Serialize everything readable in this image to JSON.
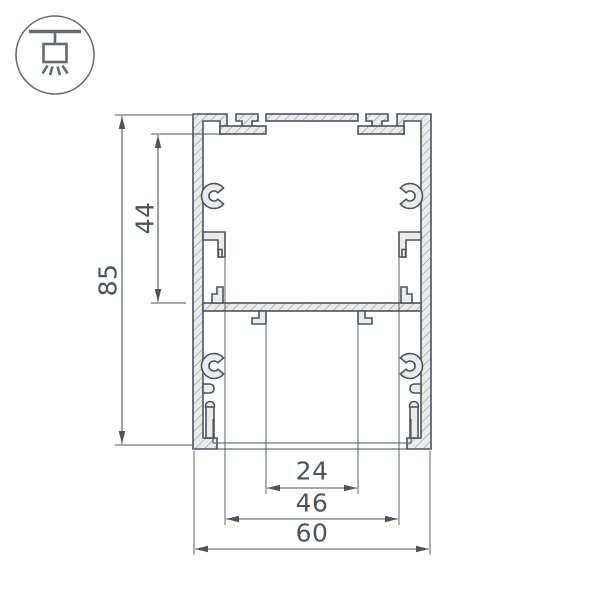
{
  "icon": {
    "name": "ceiling-pendant-light"
  },
  "dimensions": {
    "overall_height": "85",
    "cavity_height": "44",
    "slot_width": "24",
    "opening_width": "46",
    "overall_width": "60"
  },
  "colors": {
    "line": "#4d545b",
    "profile_fill": "#e9ebec",
    "hatch": "#8a9096",
    "icon_stroke": "#666b71",
    "background": "#ffffff"
  }
}
